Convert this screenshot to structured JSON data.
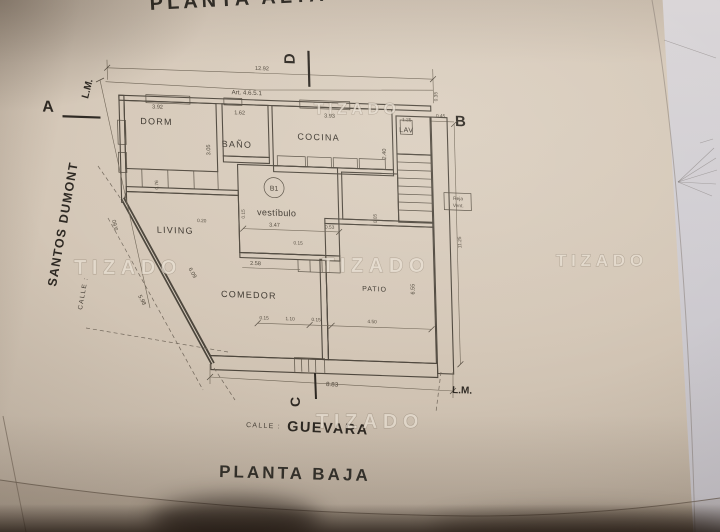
{
  "watermark": {
    "text": "TIZADO"
  },
  "titles": {
    "top_partial": "PLANTA ALTA",
    "bottom": "PLANTA BAJA"
  },
  "streets": {
    "left_prefix": "CALLE :",
    "left_name": "SANTOS DUMONT",
    "bottom_prefix": "CALLE :",
    "bottom_name": "GUEVARA"
  },
  "markers": {
    "a": "A",
    "b": "B",
    "c": "C",
    "d": "D",
    "lm_top": "L.M.",
    "lm_bottom": "L.M."
  },
  "note": {
    "article": "Art. 4.6.5.1"
  },
  "rooms": {
    "dorm": "DORM",
    "banio": "BAÑO",
    "cocina": "COCINA",
    "lav": "LAV",
    "living": "LIVING",
    "vestibulo": "vestíbulo",
    "vestibulo_tag": "B1",
    "comedor": "COMEDOR",
    "patio": "PATIO"
  },
  "annotations": {
    "reja_line1": "Reja",
    "reja_line2": "Vent."
  },
  "dims": {
    "lot_top": "12.92",
    "top_offset": "0.35",
    "right_offset": "0.45",
    "lot_left": "9.60",
    "lot_right": "11.25",
    "lot_bottom": "8.83",
    "dorm_w": "3.92",
    "dorm_h": "3.05",
    "banio_w": "1.62",
    "cocina_w": "3.93",
    "cocina_h": "2.40",
    "lav_w": "1.25",
    "closet_d": "0.76",
    "living_gap": "0.20",
    "vest_w": "3.47",
    "vest_r": "0.53",
    "vest_wall": "0.15",
    "vest_side": "0.15",
    "patio_gap": "0.05",
    "diag_wall": "6.09",
    "diag_lot": "5.98",
    "comedor_w": "2.58",
    "patio_h": "6.55",
    "bottom_1": "0.15",
    "bottom_2": "1.10",
    "bottom_3": "0.15",
    "bottom_4": "4.50"
  },
  "colors": {
    "paper": "#d4c7b7",
    "ink": "#3f3931",
    "shadow": "#18100a"
  }
}
